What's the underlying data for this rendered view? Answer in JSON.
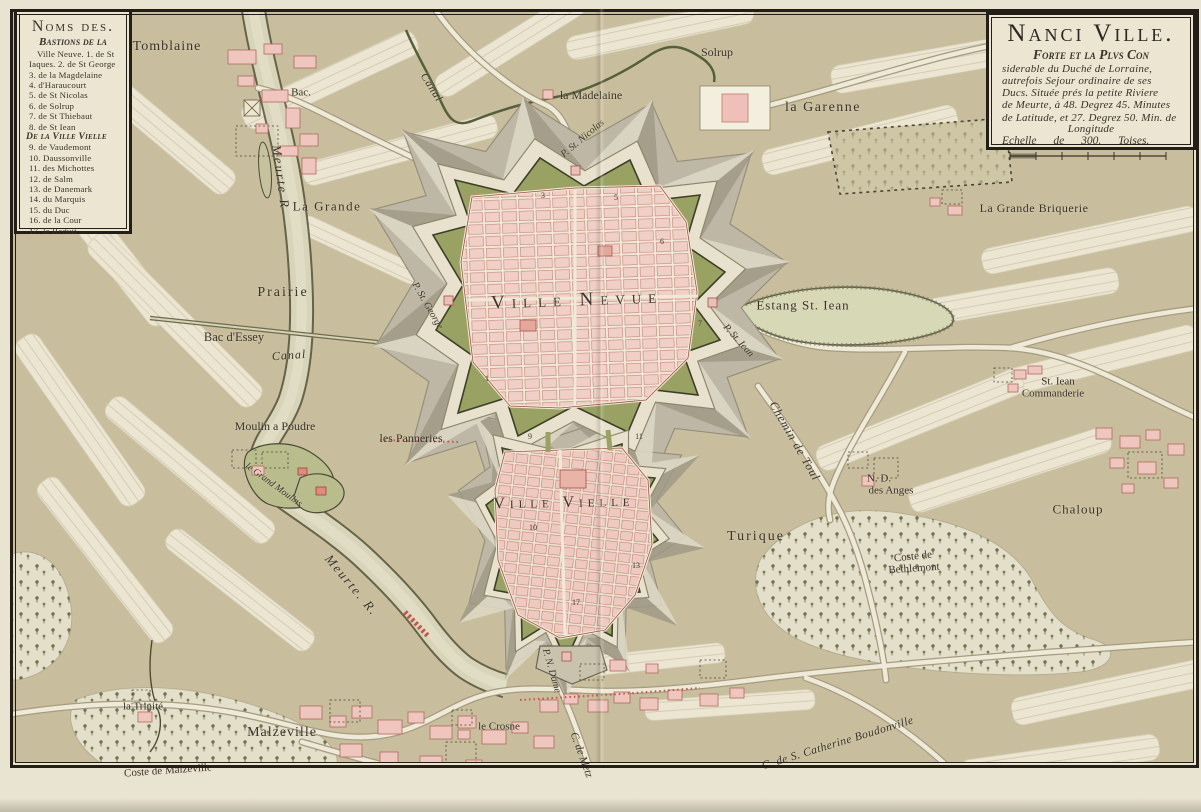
{
  "colors": {
    "paper": "#e9e3d1",
    "map_bg": "#c8be9d",
    "field": "#ebe5d2",
    "city_pink": "#f0cfc7",
    "rampart_green": "#99a263",
    "glacis_gray": "#beb7a6",
    "water": "#d7d4ba",
    "ink": "#3a332a",
    "red_accent": "#c4544a"
  },
  "legend_box": {
    "title": "Noms des.",
    "subtitle": "Bastions de la",
    "items": [
      "Ville Neuve. 1. de St",
      "Iaques. 2. de St George",
      "3. de la Magdelaine",
      "4. d'Haraucourt",
      "5. de St Nicolas",
      "6. de Solrup",
      "7. de St Thiebaut",
      "8. de St Iean",
      "De la Ville Vielle",
      "9. de Vaudemont",
      "10. Daussonville",
      "11. des Michottes",
      "12. de Salm",
      "13. de Danemark",
      "14. du Marquis",
      "15. du Duc",
      "16. de la Cour",
      "17. le Reduit"
    ]
  },
  "title_box": {
    "title": "Nanci Ville.",
    "subtitle": "Forte et la Plvs Con",
    "lines": [
      "siderable du Duché de Lorraine,",
      "autrefois Sejour ordinaire de ses",
      "Ducs. Située prés la petite Riviere",
      "de Meurte, à 48. Degrez 45. Minutes",
      "de Latitude, et 27. Degrez 50. Min. de",
      "Longitude"
    ],
    "scale_label": "Echelle de 300. Toises."
  },
  "labels": {
    "tomblaine": "Tomblaine",
    "bac": "Bac.",
    "canal_top": "Canal",
    "la_madelaine": "la Madelaine",
    "solrup": "Solrup",
    "la_garenne": "la Garenne",
    "grande_briquerie": "La Grande Briquerie",
    "meurte_top": "Meurte R",
    "la_grande": "La Grande",
    "prairie": "Prairie",
    "bac_dessey": "Bac d'Essey",
    "canal_bottom": "Canal",
    "p_st_george": "P. St. George",
    "ville_neuve": "Ville Nevue",
    "estang": "Estang St. Iean",
    "p_st_jean": "P. St. Iean",
    "p_st_nicolas": "P. St. Nicolas",
    "st_jean_com_1": "St. Iean",
    "st_jean_com_2": "Commanderie",
    "chemin_de_toul": "Chemin de Toul",
    "nd_anges_1": "N. D.",
    "nd_anges_2": "des Anges",
    "moulin_a_poudre": "Moulin a Poudre",
    "les_panneries": "les Panneries",
    "le_grand_moulin": "le Grand Moulins",
    "ville_vieille": "Ville Vielle",
    "turique": "Turique",
    "coste_beth_1": "Coste de",
    "coste_beth_2": "Bethlemont",
    "chaloup": "Chaloup",
    "meurte_bottom": "Meurte. R.",
    "p_n_dame": "P. N. Dame",
    "la_trinite": "la Trinité",
    "malzeville": "Malzeville",
    "coste_malzeville": "Coste de Malzeville",
    "le_crosne": "le Crosne",
    "c_de_metz": "C. de Metz",
    "c_catherine": "C. de S. Catherine Boudonville"
  },
  "fort_numbers": {
    "n1": "1",
    "n3": "3",
    "n5": "5",
    "n6": "6",
    "n7": "7",
    "n9": "9",
    "n10": "10",
    "n11": "11",
    "n13": "13",
    "n17": "17"
  }
}
